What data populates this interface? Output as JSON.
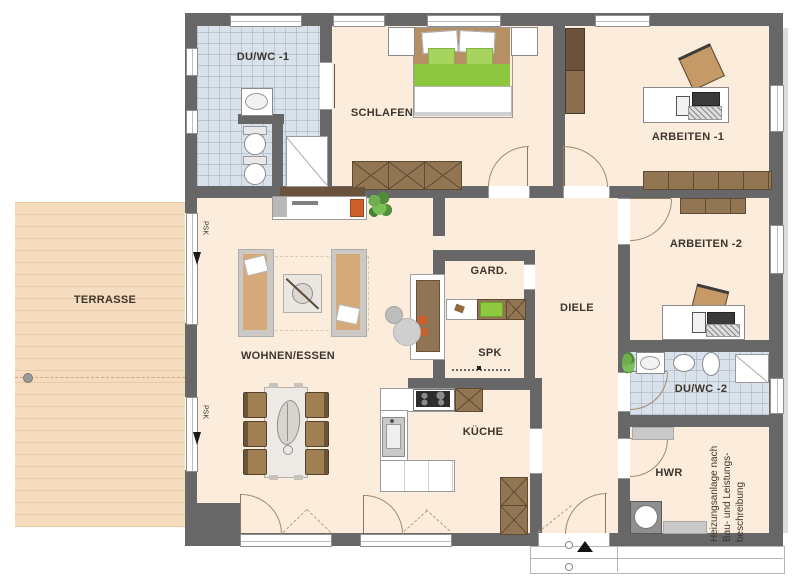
{
  "colors": {
    "wall": "#676767",
    "floor": "#fcecdb",
    "terrace": "#f6dcbe",
    "bath_tile": "#d9e1ea",
    "wood_cabinet": "#927654",
    "accent_green": "#8cc63e",
    "accent_orange": "#cd5f2a"
  },
  "rooms": {
    "duwc1": "DU/WC -1",
    "schlafen": "SCHLAFEN",
    "arbeiten1": "ARBEITEN -1",
    "arbeiten2": "ARBEITEN -2",
    "terrasse": "TERRASSE",
    "wohnen": "WOHNEN/ESSEN",
    "gard": "GARD.",
    "diele": "DIELE",
    "spk": "SPK",
    "kueche": "KÜCHE",
    "duwc2": "DU/WC -2",
    "hwr": "HWR"
  },
  "annotations": {
    "psk_left_top": "PSK",
    "psk_left_bottom": "PSK",
    "heizung": {
      "line1": "Heizungsanlage nach",
      "line2": "Bau- und Leistungs-",
      "line3": "beschreibung"
    }
  }
}
